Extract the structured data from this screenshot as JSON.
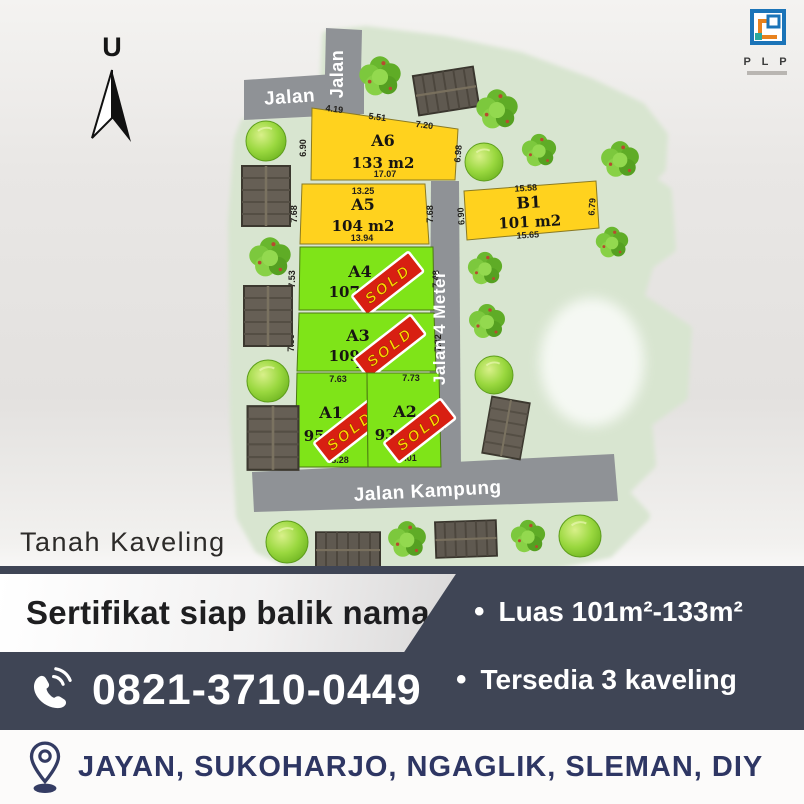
{
  "map": {
    "north_label": "U",
    "caption": "Tanah Kaveling",
    "sold_stamp": "SOLD",
    "roads": {
      "top": "Jalan",
      "top_vertical": "Jalan",
      "middle_vertical": "Jalan 4 Meter",
      "bottom": "Jalan Kampung"
    },
    "plots": [
      {
        "id": "A6",
        "area": "133 m2",
        "status": "available",
        "dims": {
          "top_left": "4.19",
          "top_mid": "5.51",
          "top_right": "7.20",
          "left": "6.90",
          "right": "6.98",
          "bottom": "17.07"
        }
      },
      {
        "id": "A5",
        "area": "104 m2",
        "status": "available",
        "dims": {
          "top": "13.25",
          "left": "7.68",
          "right": "7.68",
          "bottom": "13.94"
        }
      },
      {
        "id": "B1",
        "area": "101 m2",
        "status": "available",
        "dims": {
          "top": "15.58",
          "left": "6.90",
          "right": "6.79",
          "bottom": "15.65"
        }
      },
      {
        "id": "A4",
        "area": "107 m2",
        "status": "sold",
        "dims": {
          "left": "7.53",
          "right": "7.48",
          "bottom": "14.8"
        }
      },
      {
        "id": "A3",
        "area": "109 m2",
        "status": "sold",
        "dims": {
          "left": "7.36",
          "right": "7.32",
          "bottom": "15.36"
        }
      },
      {
        "id": "A1",
        "area": "95 m2",
        "status": "sold",
        "dims": {
          "top": "7.63",
          "left": "12.19",
          "right": "12.34",
          "bottom": "8.28"
        }
      },
      {
        "id": "A2",
        "area": "93 m2",
        "status": "sold",
        "dims": {
          "top": "7.73",
          "right": "12.3",
          "bottom": "8.01"
        }
      }
    ]
  },
  "logo": {
    "text": "P L P"
  },
  "banner": {
    "headline": "Sertifikat siap balik nama",
    "phone": "0821-3710-0449",
    "bullets": [
      {
        "marker": "•",
        "label": "Luas 101m²-133m²"
      },
      {
        "marker": "•",
        "label": "Tersedia 3 kaveling"
      }
    ]
  },
  "footer": {
    "location": "JAYAN, SUKOHARJO, NGAGLIK, SLEMAN, DIY"
  },
  "colors": {
    "available_plot": "#FFD21E",
    "sold_plot": "#7FE418",
    "sold_stamp": "#D81F12",
    "road": "#8F9296",
    "band": "#3F4555",
    "footer_text": "#2E3663"
  }
}
